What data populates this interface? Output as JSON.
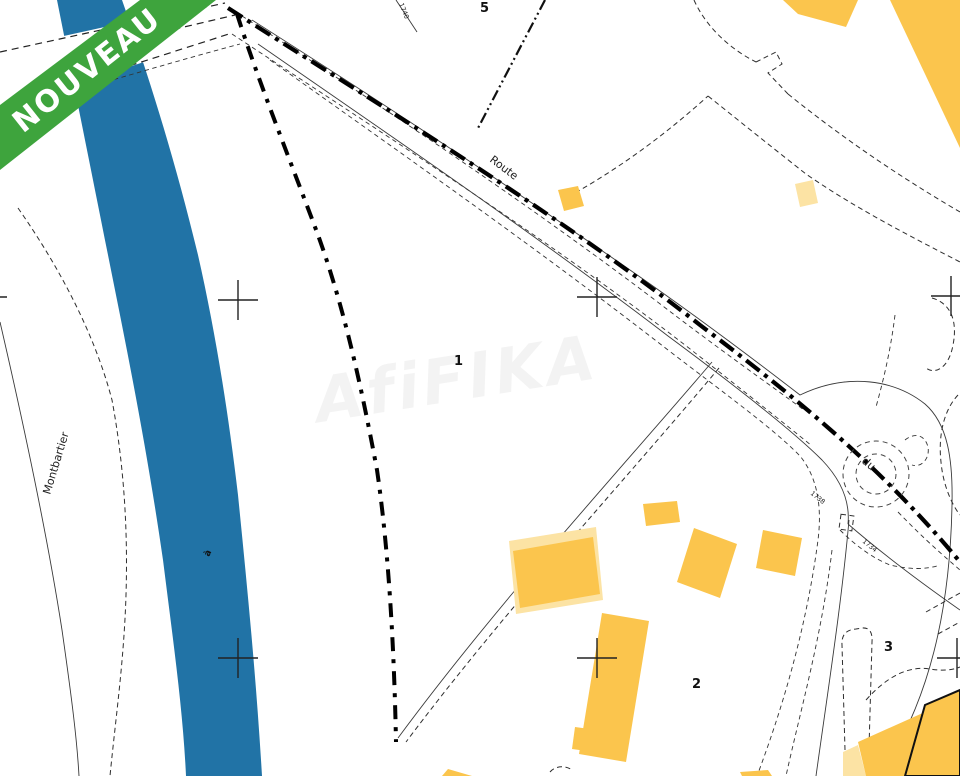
{
  "banner": {
    "label": "NOUVEAU"
  },
  "colors": {
    "banner": "#3ea43d",
    "river": "#2173a6",
    "building": "#fbc54d",
    "building_light": "#fce3a4"
  },
  "labels": {
    "commune": "Montbartier",
    "river": "à",
    "road": "Route",
    "road2": "du",
    "watermark": "AfiFIKA"
  },
  "parcel_numbers": [
    "5",
    "1",
    "2",
    "3"
  ],
  "lot_numbers": [
    "1740",
    "1738",
    "1734"
  ]
}
